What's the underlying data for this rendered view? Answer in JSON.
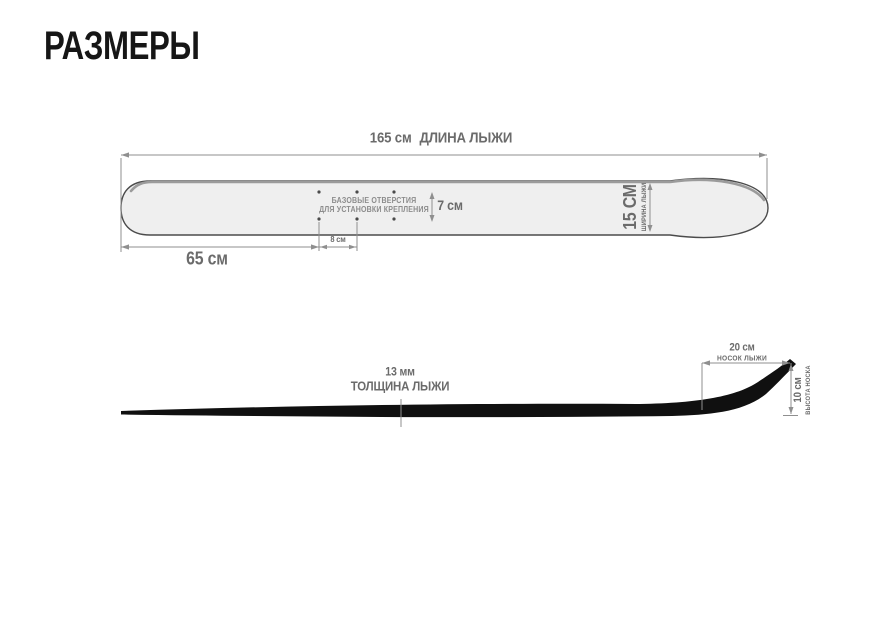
{
  "page": {
    "title": "РАЗМЕРЫ"
  },
  "colors": {
    "title_text": "#161616",
    "dimension_text": "#6b6b6b",
    "note_text": "#8c8c8c",
    "dimension_line": "#8f8f8f",
    "ski_fill": "#efefef",
    "ski_outline": "#4b4b4b",
    "ski_top_shade": "#9b9b9b",
    "profile_fill": "#101010"
  },
  "top_view": {
    "length": {
      "value": "165 см",
      "label": "ДЛИНА ЛЫЖИ"
    },
    "tail_to_holes": {
      "value": "65 см"
    },
    "hole_spacing": {
      "value": "8 см"
    },
    "hole_row_gap": {
      "value": "7 см"
    },
    "width": {
      "value": "15 СМ",
      "label": "ШИРИНА ЛЫЖИ"
    },
    "holes_note": {
      "line1": "БАЗОВЫЕ ОТВЕРСТИЯ",
      "line2": "ДЛЯ УСТАНОВКИ КРЕПЛЕНИЯ"
    },
    "holes_count": 6
  },
  "side_view": {
    "thickness": {
      "value": "13 мм",
      "label": "ТОЛЩИНА ЛЫЖИ"
    },
    "tip_length": {
      "value": "20 см",
      "label": "НОСОК ЛЫЖИ"
    },
    "tip_height": {
      "value": "10 см",
      "label": "ВЫСОТА НОСКА"
    }
  }
}
